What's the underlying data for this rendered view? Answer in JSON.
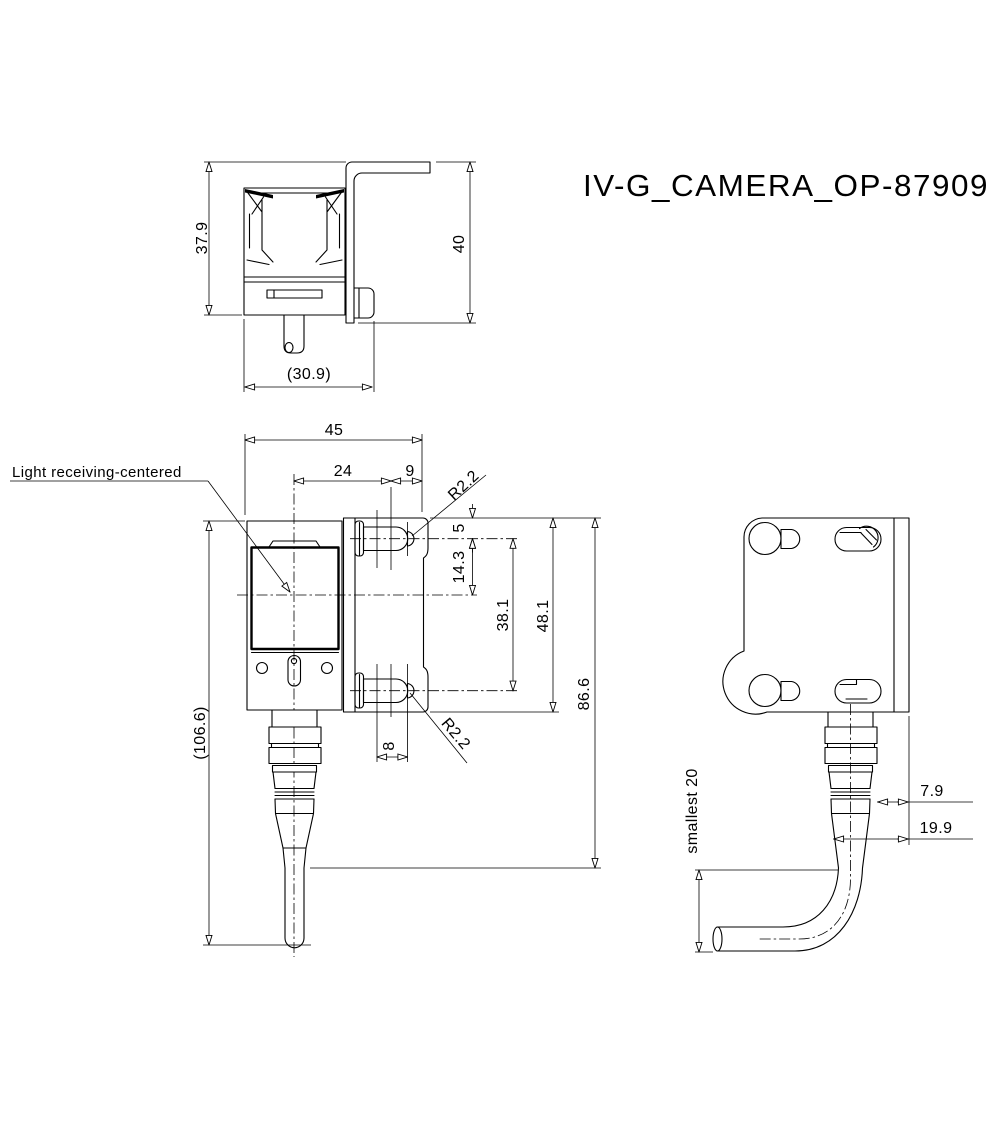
{
  "title": "IV-G_CAMERA_OP-87909",
  "top_view": {
    "dim_body_depth": "37.9",
    "dim_bracket_depth": "40",
    "dim_overall_depth_ref": "(30.9)"
  },
  "front_view": {
    "label_light_receiving": "Light receiving-centered",
    "dim_width_total": "45",
    "dim_center_to_screw": "24",
    "dim_screw_to_edge": "9",
    "dim_radius_top": "R2.2",
    "dim_screw_offset_top": "5",
    "dim_center_offset": "14.3",
    "dim_screw_spacing": "38.1",
    "dim_bracket_height": "48.1",
    "dim_body_to_cable": "86.6",
    "dim_overall_height_ref": "(106.6)",
    "dim_screw_head_width": "8",
    "dim_radius_bottom": "R2.2"
  },
  "side_view": {
    "dim_min_bend": "smallest 20",
    "dim_plate_to_connector": "7.9",
    "dim_plate_to_cable": "19.9"
  }
}
